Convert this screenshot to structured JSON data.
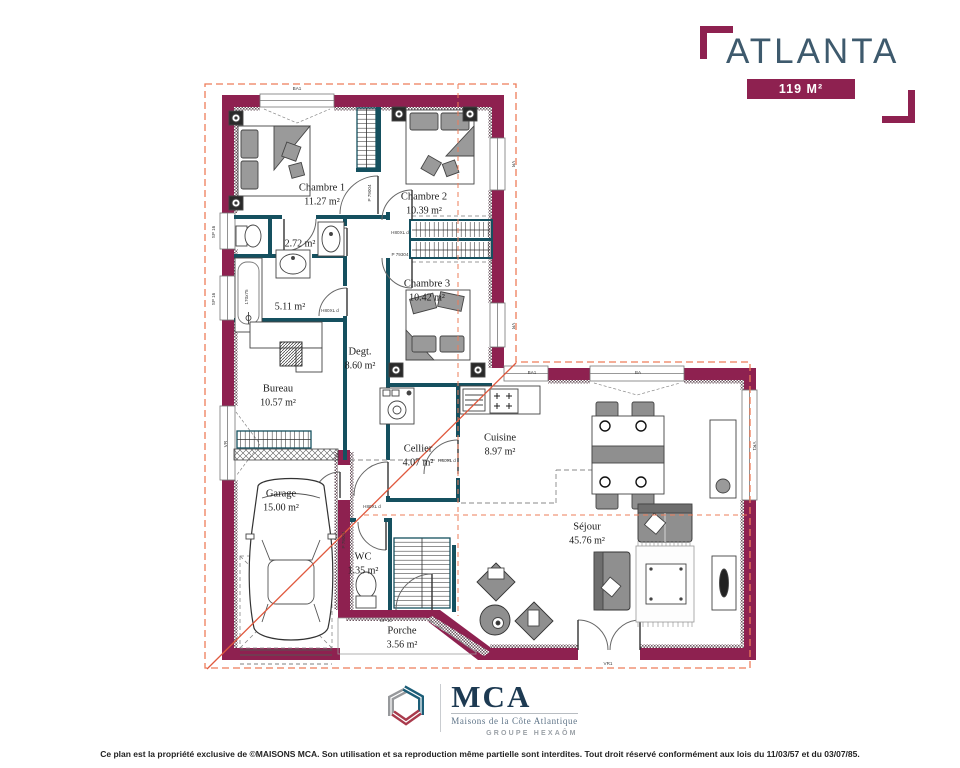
{
  "header": {
    "title": "ATLANTA",
    "area_label": "119 M²"
  },
  "plan": {
    "colors": {
      "exterior_wall": "#8e2150",
      "partition_wall": "#15505f",
      "roof_line": "#ee7c59",
      "roof_hip": "#e0593e",
      "title_text": "#3e5a6d"
    },
    "rooms": [
      {
        "id": "chambre-1",
        "name": "Chambre 1",
        "area": "11.27 m²",
        "x": 322,
        "y": 195
      },
      {
        "id": "chambre-2",
        "name": "Chambre 2",
        "area": "10.39 m²",
        "x": 424,
        "y": 204
      },
      {
        "id": "chambre-3",
        "name": "Chambre 3",
        "area": "10.42 m²",
        "x": 427,
        "y": 291
      },
      {
        "id": "salle-eau",
        "name": "",
        "area": "2.72 m²",
        "x": 300,
        "y": 244
      },
      {
        "id": "salle-bain",
        "name": "",
        "area": "5.11 m²",
        "x": 290,
        "y": 307
      },
      {
        "id": "bureau",
        "name": "Bureau",
        "area": "10.57 m²",
        "x": 278,
        "y": 396
      },
      {
        "id": "degagement",
        "name": "Degt.",
        "area": "8.60 m²",
        "x": 360,
        "y": 359
      },
      {
        "id": "cellier",
        "name": "Cellier",
        "area": "4.07 m²",
        "x": 418,
        "y": 456
      },
      {
        "id": "cuisine",
        "name": "Cuisine",
        "area": "8.97 m²",
        "x": 500,
        "y": 445
      },
      {
        "id": "garage",
        "name": "Garage",
        "area": "15.00 m²",
        "x": 281,
        "y": 501
      },
      {
        "id": "wc",
        "name": "WC",
        "area": "1.35 m²",
        "x": 363,
        "y": 564
      },
      {
        "id": "sejour",
        "name": "Séjour",
        "area": "45.76 m²",
        "x": 587,
        "y": 534
      },
      {
        "id": "porche",
        "name": "Porche",
        "area": "3.56 m²",
        "x": 402,
        "y": 638
      }
    ],
    "micro_labels": [
      {
        "text": "BA1",
        "x": 297,
        "y": 90,
        "rot": 0
      },
      {
        "text": "VR",
        "x": 512,
        "y": 164,
        "rot": 90
      },
      {
        "text": "VR",
        "x": 512,
        "y": 326,
        "rot": 90
      },
      {
        "text": "SP 16",
        "x": 215,
        "y": 232,
        "rot": -90
      },
      {
        "text": "SP 16",
        "x": 215,
        "y": 299,
        "rot": -90
      },
      {
        "text": "VR",
        "x": 227,
        "y": 444,
        "rot": -90
      },
      {
        "text": "BA1",
        "x": 532,
        "y": 374,
        "rot": 0
      },
      {
        "text": "BA",
        "x": 638,
        "y": 374,
        "rot": 0
      },
      {
        "text": "VR1",
        "x": 753,
        "y": 446,
        "rot": 90
      },
      {
        "text": "VR1",
        "x": 608,
        "y": 665,
        "rot": 0
      },
      {
        "text": "SP 10",
        "x": 386,
        "y": 622,
        "rot": 0
      },
      {
        "text": "170x75",
        "x": 248,
        "y": 297,
        "rot": -90
      },
      {
        "text": "P 79004",
        "x": 371,
        "y": 193,
        "rot": -90
      },
      {
        "text": "P 79004",
        "x": 345,
        "y": 540,
        "rot": -90
      },
      {
        "text": "H80XL d",
        "x": 400,
        "y": 234,
        "rot": 0
      },
      {
        "text": "P 79304",
        "x": 400,
        "y": 256,
        "rot": 0
      },
      {
        "text": "H80XL d",
        "x": 330,
        "y": 312,
        "rot": 0
      },
      {
        "text": "H80XL d",
        "x": 447,
        "y": 462,
        "rot": 0
      },
      {
        "text": "H80XL d",
        "x": 372,
        "y": 508,
        "rot": 0
      }
    ]
  },
  "logo": {
    "mca": "MCA",
    "tagline": "Maisons de la Côte Atlantique",
    "group": "GROUPE HEXAÔM"
  },
  "footer": {
    "copyright": "Ce plan est la propriété exclusive de ©MAISONS MCA. Son utilisation et sa reproduction même partielle sont interdites. Tout droit réservé conformément aux lois du 11/03/57 et du 03/07/85."
  }
}
